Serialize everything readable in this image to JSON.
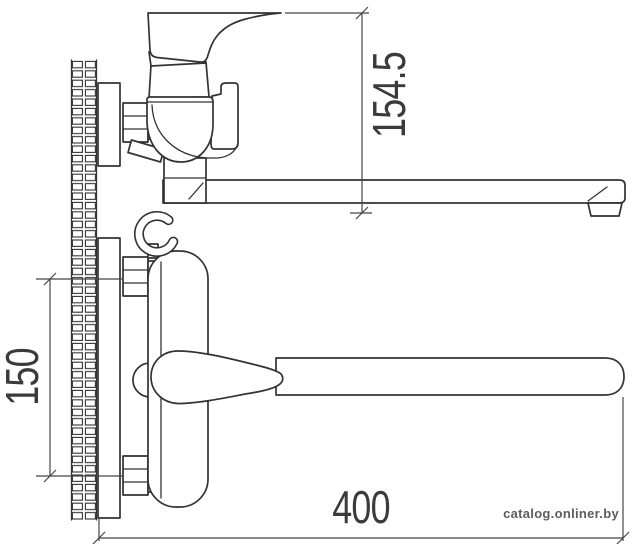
{
  "drawing": {
    "type": "technical dimension drawing",
    "subject": "wall-mounted bath mixer faucet with long swivel spout, side view and plan view",
    "line_color": "#333333",
    "dimension_color": "#454545",
    "background_color": "#ffffff"
  },
  "dimensions": {
    "spout_height": "154.5",
    "mount_spacing": "150",
    "spout_reach": "400"
  },
  "watermark": {
    "text": "catalog.onliner.by",
    "color": "#5c5c5c"
  }
}
